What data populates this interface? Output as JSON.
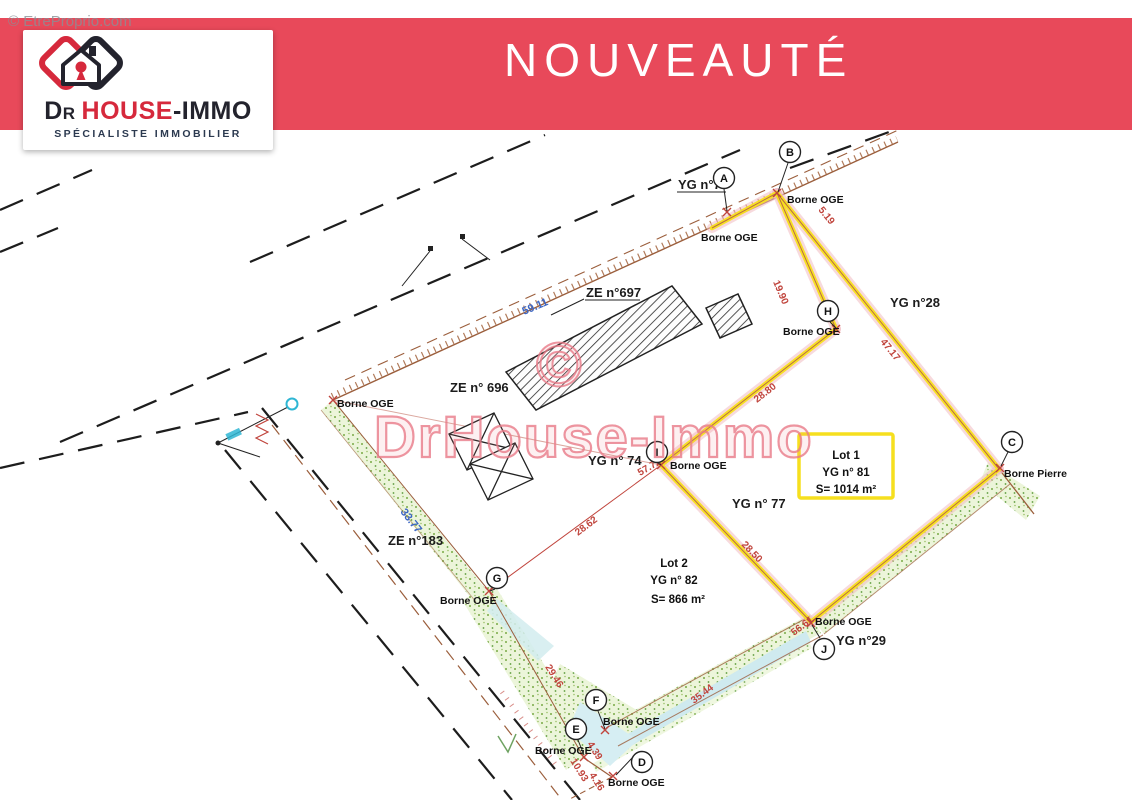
{
  "watermarks": {
    "corner": "© EtreProprio.com",
    "center": "DrHouse-Immo",
    "copyright_symbol": "©"
  },
  "banner": {
    "title": "NOUVEAUTÉ",
    "color": "#e8495a"
  },
  "logo": {
    "d": "D",
    "r": "R",
    "house": "HOUSE",
    "immo": "-IMMO",
    "tagline": "SPÉCIALISTE IMMOBILIER",
    "brand_red": "#d6293c",
    "brand_dark": "#23232d"
  },
  "plan": {
    "parcel_labels": [
      "YG n°75",
      "ZE n°697",
      "ZE n° 696",
      "YG n°28",
      "YG n° 74",
      "YG n° 77",
      "ZE n°183",
      "YG n°29"
    ],
    "borne_labels": [
      "Borne OGE",
      "Borne OGE",
      "Borne OGE",
      "Borne OGE",
      "Borne OGE",
      "Borne Pierre",
      "Borne OGE",
      "Borne OGE",
      "Borne OGE",
      "Borne OGE",
      "Borne OGE"
    ],
    "points": [
      "A",
      "B",
      "H",
      "C",
      "I",
      "G",
      "J",
      "F",
      "E",
      "D"
    ],
    "measures_red": [
      "5.19",
      "19.90",
      "47.17",
      "28.80",
      "57.72",
      "28.62",
      "28.50",
      "56.61",
      "35.44",
      "29.46",
      "10.93",
      "4.39",
      "4.16"
    ],
    "measures_blue": [
      "59.11",
      "33.77"
    ],
    "lot1": {
      "title": "Lot 1",
      "parcel": "YG n° 81",
      "area": "S= 1014 m²"
    },
    "lot2": {
      "title": "Lot 2",
      "parcel": "YG n° 82",
      "area": "S= 866 m²"
    },
    "colors": {
      "boundary_highlight": "#f8e11c",
      "measure_red": "#c0443c",
      "measure_blue": "#3b66c4",
      "vegetation": "#79aa46",
      "road_line": "#1d1d1d",
      "cadastre_line": "#9b5e3c"
    }
  }
}
